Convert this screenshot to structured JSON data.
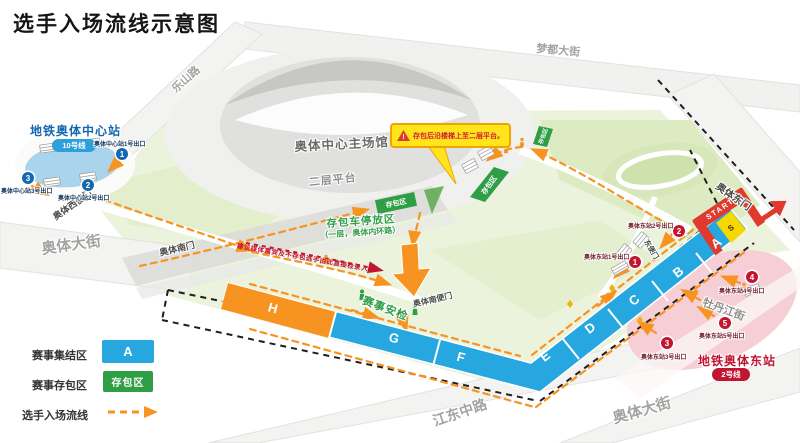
{
  "title": "选手入场流线示意图",
  "roads": {
    "leshan": "乐山路",
    "mengdu": "梦都大街",
    "aoti_west": "奥体大街",
    "jiangdong": "江东中路",
    "aoti_east": "奥体大街",
    "mudanjiang": "牡丹江街"
  },
  "gates": {
    "west_side": "奥体西便门",
    "south": "奥体南门",
    "south_side": "奥体南便门",
    "east": "奥体东门",
    "east_side": "东便门"
  },
  "stadium": {
    "main_label": "奥体中心主场馆",
    "platform_label": "二层平台"
  },
  "bag": {
    "parking_line1": "存包车停放区",
    "parking_line2": "（一层，奥体内环路）",
    "zone_label": "存包区",
    "callout": "存包后沿楼梯上至二层平台。"
  },
  "security_label": "赛事安检",
  "note_direct": "建议媒体嘉宾及不存包选手由此直接检录入场",
  "metro_west": {
    "name": "地铁奥体中心站",
    "line": "10号线",
    "exits": [
      {
        "n": "1",
        "label": "奥体中心站1号出口"
      },
      {
        "n": "2",
        "label": "奥体中心站2号出口"
      },
      {
        "n": "3",
        "label": "奥体中心站3号出口"
      }
    ]
  },
  "metro_east": {
    "name": "地铁奥体东站",
    "line": "2号线",
    "exits": [
      {
        "n": "1",
        "label": "奥体东站1号出口"
      },
      {
        "n": "2",
        "label": "奥体东站2号出口"
      },
      {
        "n": "3",
        "label": "奥体东站3号出口"
      },
      {
        "n": "4",
        "label": "奥体东站4号出口"
      },
      {
        "n": "5",
        "label": "奥体东站5号出口"
      }
    ]
  },
  "course": {
    "start_label": "START",
    "s_label": "S",
    "zones": [
      "A",
      "B",
      "C",
      "D",
      "E",
      "F",
      "G",
      "H"
    ]
  },
  "legend": {
    "rows": [
      {
        "label": "赛事集结区",
        "swatch": "A"
      },
      {
        "label": "赛事存包区",
        "swatch": "存包区"
      },
      {
        "label": "选手入场流线"
      }
    ]
  },
  "colors": {
    "zone_blue": "#27a7e0",
    "zone_orange": "#f79421",
    "bag_green": "#2f9e45",
    "metro_west_blue": "#1368b0",
    "metro_east_red": "#c2152f",
    "flow_orange": "#f79421",
    "callout_yellow": "#ffe51a",
    "start_red": "#e03a2f",
    "s_yellow": "#f6d800"
  }
}
